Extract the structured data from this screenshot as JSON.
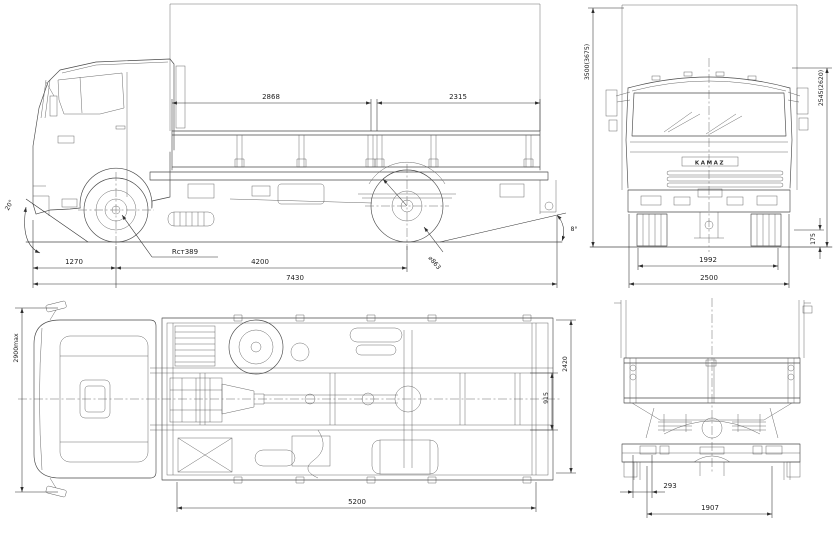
{
  "drawing": {
    "title": "truck-blueprint-four-views",
    "line_color": "#4a4a4a",
    "dim_color": "#2e2e2e",
    "background": "#ffffff"
  },
  "side_view": {
    "dim_body_front": "2868",
    "dim_body_rear": "2315",
    "dim_front_overhang": "1270",
    "dim_wheelbase": "4200",
    "dim_overall_length": "7430",
    "approach_angle": "20°",
    "departure_angle": "8°",
    "static_radius": "Rст389",
    "tire_diameter": "⌀863"
  },
  "front_view": {
    "dim_overall_height": "3500(3675)",
    "dim_cab_height": "2545(2620)",
    "dim_clearance": "175",
    "dim_track": "1992",
    "dim_overall_width": "2500",
    "grille_text": "KAMAZ"
  },
  "top_view": {
    "dim_overall_width": "2900max",
    "dim_frame_width": "915",
    "dim_platform_width": "2420",
    "dim_platform_length": "5200"
  },
  "rear_view": {
    "dim_offset": "293",
    "dim_track": "1907"
  }
}
